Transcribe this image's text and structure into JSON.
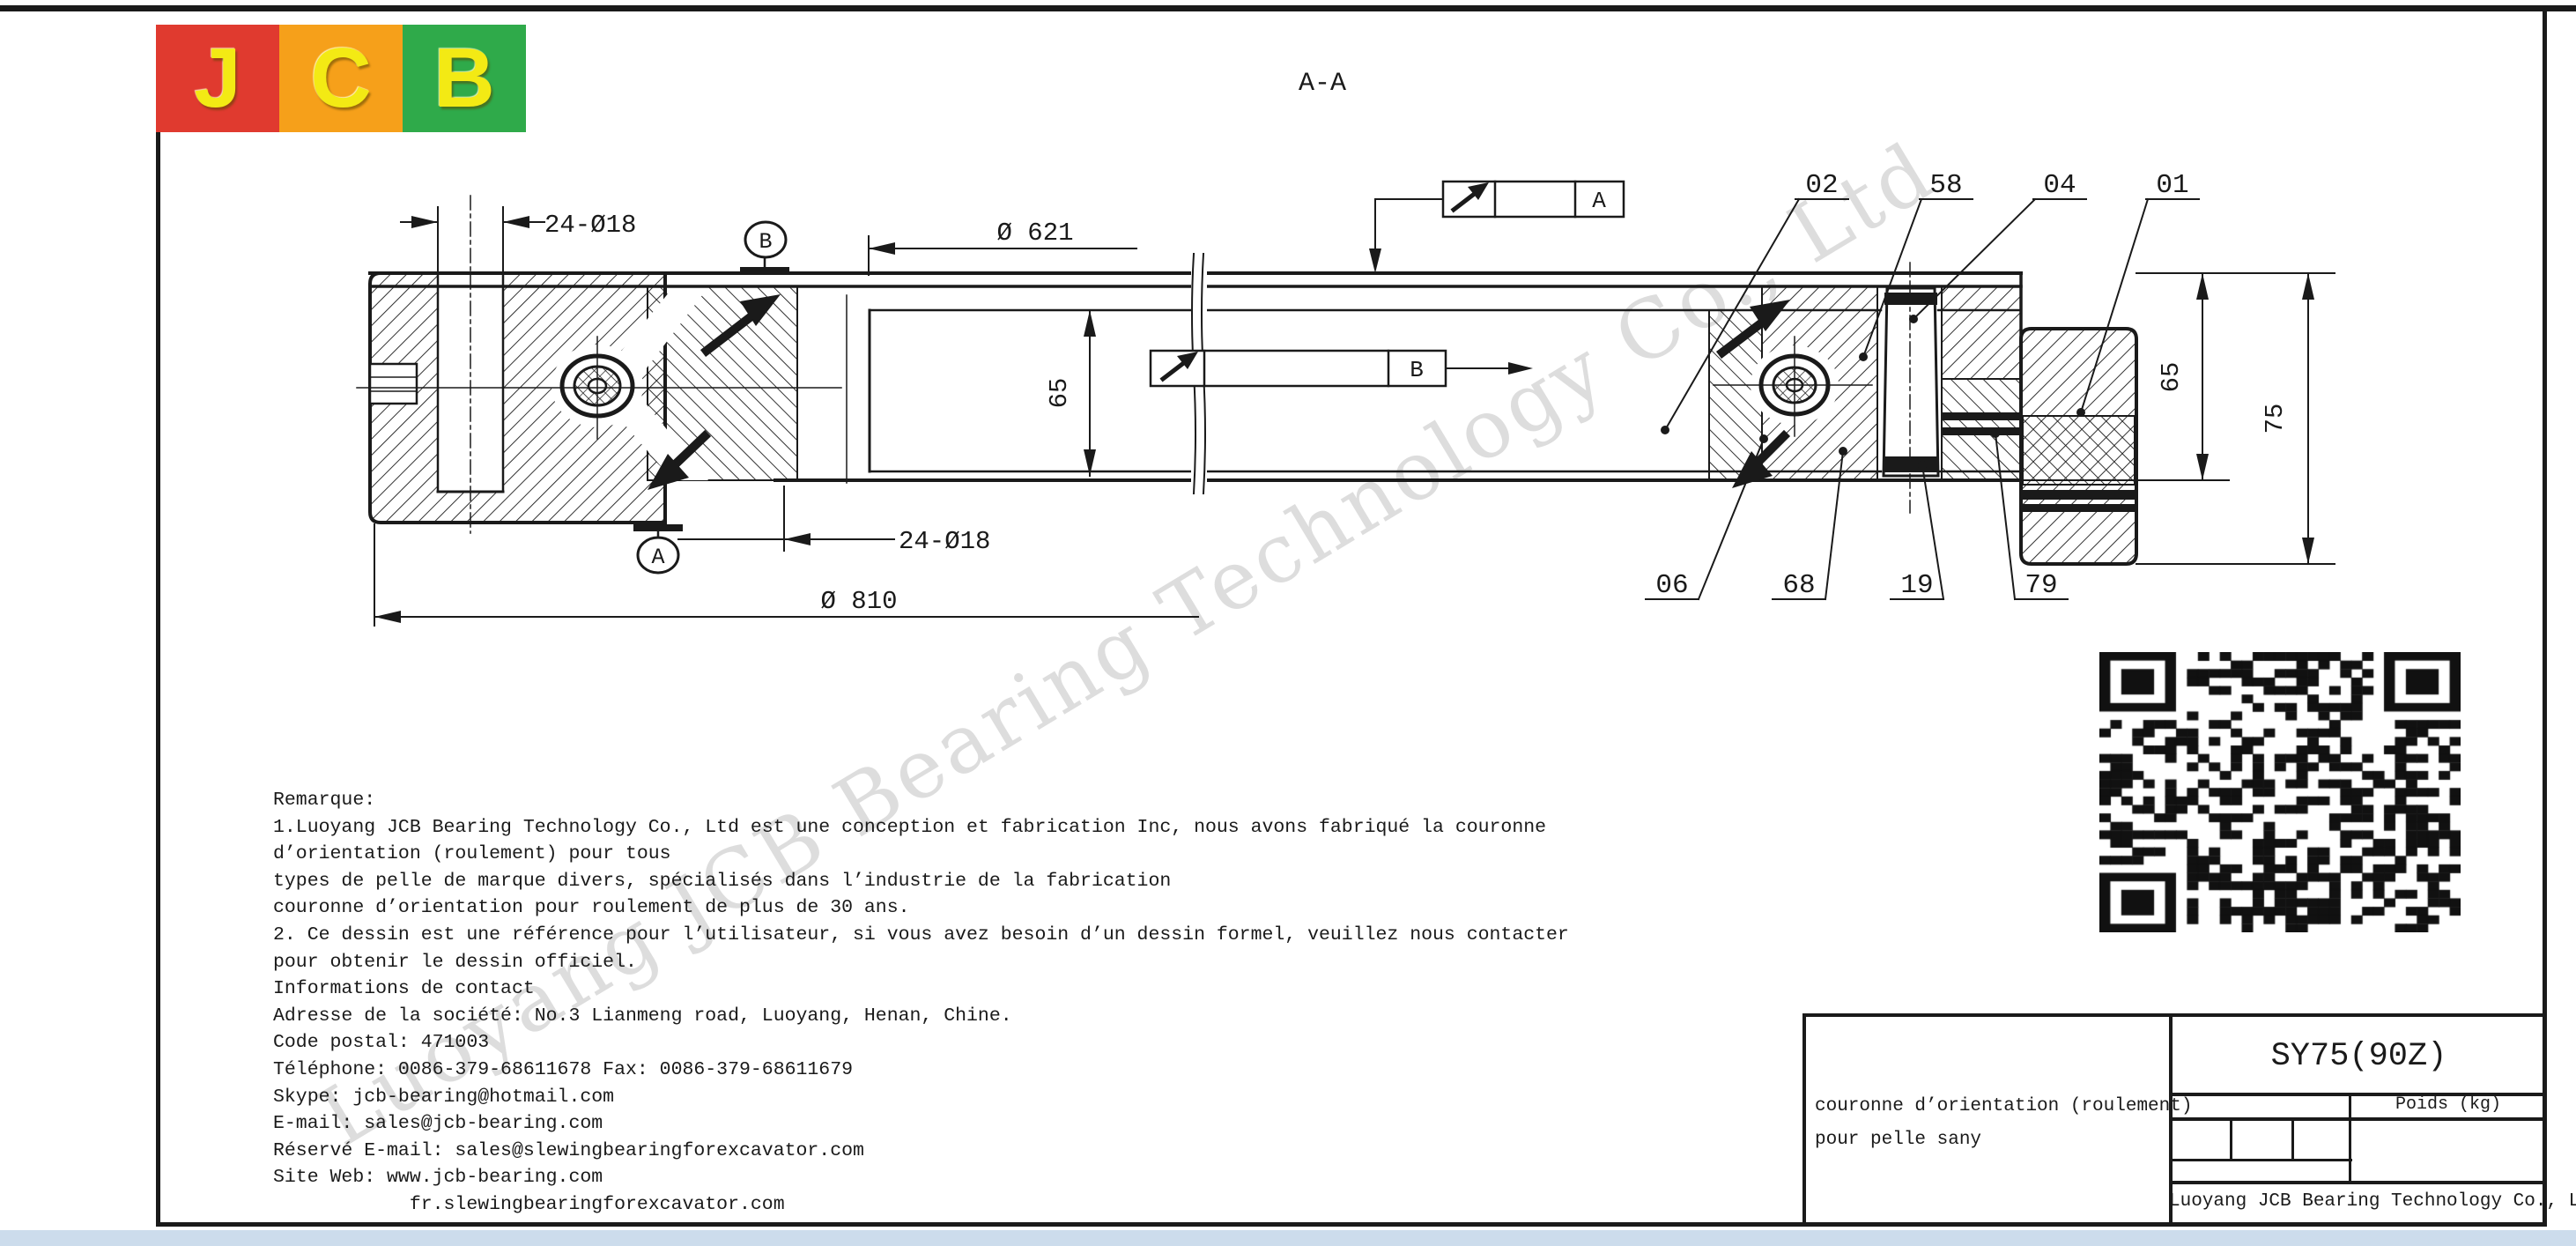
{
  "logo": {
    "letters": [
      "J",
      "C",
      "B"
    ],
    "panel_colors": [
      "#e03a2f",
      "#f6a01a",
      "#2faa4a"
    ],
    "letter_color": "#f3ea14"
  },
  "section_label": "A-A",
  "drawing": {
    "dimensions": {
      "bolt_top": "24-Ø18",
      "bolt_bottom": "24-Ø18",
      "outer_diameter": "Ø 810",
      "inner_diameter": "Ø 621",
      "height_mid": "65",
      "height_right": "65",
      "total_height": "75"
    },
    "datums": {
      "top": "B",
      "bottom": "A"
    },
    "finish_boxes": {
      "top": "A",
      "mid": "B"
    },
    "callouts_top": [
      "02",
      "58",
      "04",
      "01"
    ],
    "callouts_bottom": [
      "06",
      "68",
      "19",
      "79"
    ]
  },
  "notes": {
    "lines": [
      "Remarque:",
      "1.Luoyang JCB Bearing Technology Co., Ltd est une conception et fabrication Inc, nous avons fabriqué la couronne",
      "d’orientation (roulement) pour tous",
      "types de pelle de marque divers, spécialisés dans l’industrie de la fabrication",
      "couronne d’orientation pour roulement de plus de 30 ans.",
      "2. Ce dessin est une référence pour l’utilisateur, si vous avez besoin d’un dessin formel, veuillez nous contacter",
      "pour obtenir le dessin officiel.",
      "Informations de contact",
      "Adresse de la société: No.3 Lianmeng road, Luoyang, Henan, Chine.",
      "Code postal: 471003",
      "Téléphone: 0086-379-68611678 Fax: 0086-379-68611679",
      "Skype: jcb-bearing@hotmail.com",
      "E-mail: sales@jcb-bearing.com",
      "Réservé E-mail: sales@slewingbearingforexcavator.com",
      "Site Web: www.jcb-bearing.com",
      "            fr.slewingbearingforexcavator.com"
    ]
  },
  "title_block": {
    "part_number": "SY75(90Z)",
    "weight_label": "Poids (kg)",
    "description_line1": "couronne d’orientation (roulement)",
    "description_line2": "pour pelle sany",
    "company": "Luoyang JCB Bearing Technology Co., Ltd"
  },
  "watermark_text": "Luoyang JCB Bearing Technology Co., Ltd"
}
